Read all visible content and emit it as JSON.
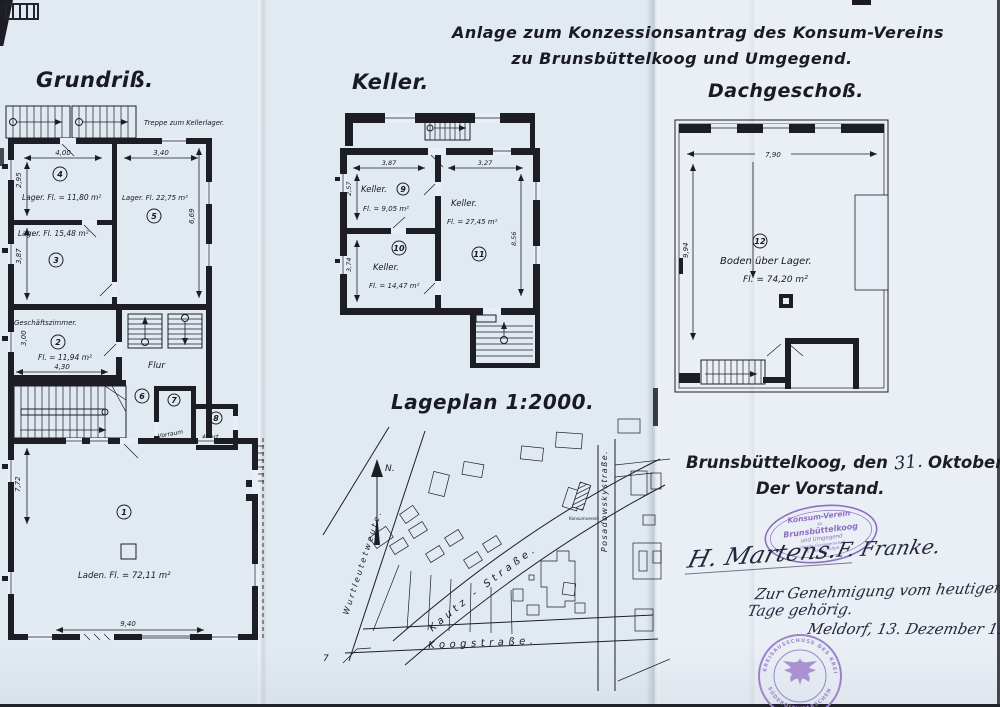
{
  "colors": {
    "ink": "#1d1d26",
    "stamp_purple": "#8d6fc1",
    "paper": "#e2eaf1"
  },
  "header": {
    "title_line1": "Anlage zum Konzessionsantrag des Konsum-Vereins",
    "title_line2": "zu Brunsbüttelkoog und Umgegend."
  },
  "grundriss": {
    "title": "Grundriß.",
    "stairs_note": "Treppe zum Kellerlager.",
    "rooms": {
      "r1": {
        "num": "1",
        "text": "Laden.  Fl. = 72,11 m²"
      },
      "r2": {
        "num": "2",
        "name": "Geschäftszimmer.",
        "area": "Fl. = 11,94 m²"
      },
      "r3": {
        "num": "3",
        "text": "Lager.  Fl. 15,48 m²"
      },
      "r4": {
        "num": "4",
        "text": "Lager.  Fl. = 11,80 m²"
      },
      "r5": {
        "num": "5",
        "text": "Lager.  Fl. 22,75 m²"
      },
      "r6": {
        "num": "6",
        "name": "Flur"
      },
      "r7": {
        "num": "7",
        "name": "Vorraum"
      },
      "r8": {
        "num": "8",
        "name": "Abort."
      }
    },
    "dims": {
      "w400": "4,00",
      "h295": "2,95",
      "w340": "3,40",
      "h669": "6,69",
      "h387": "3,87",
      "w430": "4,30",
      "h300": "3,00",
      "w940": "9,40",
      "h772": "7,72"
    }
  },
  "keller": {
    "title": "Keller.",
    "rooms": {
      "r9": {
        "num": "9",
        "name": "Keller.",
        "area": "Fl. = 9,05 m²"
      },
      "r10": {
        "num": "10",
        "name": "Keller.",
        "area": "Fl. = 14,47 m²"
      },
      "r11": {
        "num": "11",
        "name": "Keller.",
        "area": "Fl. = 27,45 m²"
      }
    },
    "dims": {
      "w387": "3,87",
      "w327": "3,27",
      "h257": "2,57",
      "h374": "3,74",
      "h856": "8,56"
    }
  },
  "dachgeschoss": {
    "title": "Dachgeschoß.",
    "rooms": {
      "r12": {
        "num": "12",
        "name": "Boden über Lager.",
        "area": "Fl. = 74,20 m²"
      }
    },
    "dims": {
      "w790": "7,90",
      "h994": "9,94"
    }
  },
  "lageplan": {
    "title": "Lageplan 1:2000.",
    "north": "N.",
    "streets": {
      "kautz": "Kautz - Straße.",
      "koog": "Koogstraße.",
      "posadowsky": "Posadowskystraße.",
      "wurtleute": "Wurtleutetweute."
    },
    "konsum_label": "Konsumverein",
    "corner_number": "7"
  },
  "footer": {
    "place_date_prefix": "Brunsbüttelkoog, den",
    "date_day": "31.",
    "date_rest": "Oktober 1932.",
    "vorstand": "Der Vorstand.",
    "oval_stamp": {
      "line1": "Konsum-Verein",
      "line2": "zu",
      "line3": "Brunsbüttelkoog",
      "line4": "und Umgegend",
      "line5": "eingetr. Genossenschaft",
      "line6": "m. beschr. Haftpfl."
    },
    "signature_left": "H. Martens.",
    "signature_right": "F. Franke.",
    "note_line1": "Zur Genehmigung vom heutigen",
    "note_line2": "Tage gehörig.",
    "note_line3": "Meldorf, 13. Dezember 1932.",
    "round_stamp": {
      "arc_top": "KREISAUSSCHUSS DES KREISES",
      "arc_bottom": "SÜDERDITHMARSCHEN"
    }
  }
}
